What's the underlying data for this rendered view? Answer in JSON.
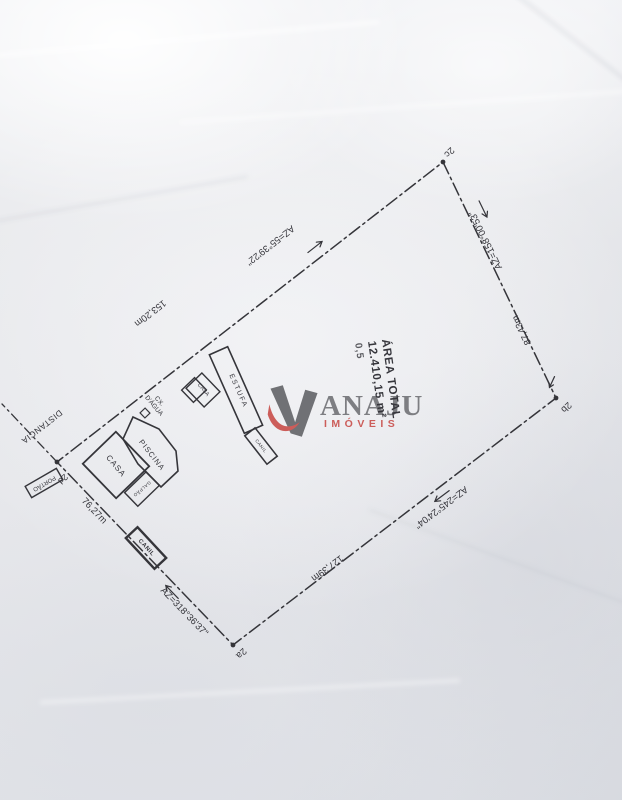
{
  "page": {
    "background": "#e9eaed",
    "ink": "#35353a"
  },
  "watermark": {
    "brand": "ANAJU",
    "tagline": "IMÓVEIS",
    "brand_color": "#6e6f73",
    "tagline_color": "#c84a46"
  },
  "area_label": {
    "line1": "ÁREA TOTAL",
    "line2": "12.410,15 m²",
    "line3": "0,5"
  },
  "corners": {
    "c2a": "2a",
    "c2b": "2b",
    "c2c": "2c",
    "c2d": "2d"
  },
  "edges": {
    "top_left": {
      "azimuth": "AZ=55°39'22\"",
      "length": "153,20m"
    },
    "top_right": {
      "azimuth": "AZ=158°00'53\"",
      "length": "87,43m"
    },
    "bottom_right": {
      "azimuth": "AZ=245°24'04\"",
      "length": "127,39m"
    },
    "bottom_left": {
      "azimuth": "AZ=318°36'37\"",
      "length": "76,27m"
    }
  },
  "features": {
    "distancia": "DISTANCIA",
    "portao": "PORTÃO",
    "casa_main": "CASA",
    "galpao": "GALPÃO",
    "piscina": "PISCINA",
    "cx_dagua_line1": "CX.",
    "cx_dagua_line2": "D'ÁGUA",
    "casa_small": "CASA",
    "estufa": "ESTUFA",
    "canil_center": "CANIL",
    "canil_boundary": "CANIL"
  }
}
